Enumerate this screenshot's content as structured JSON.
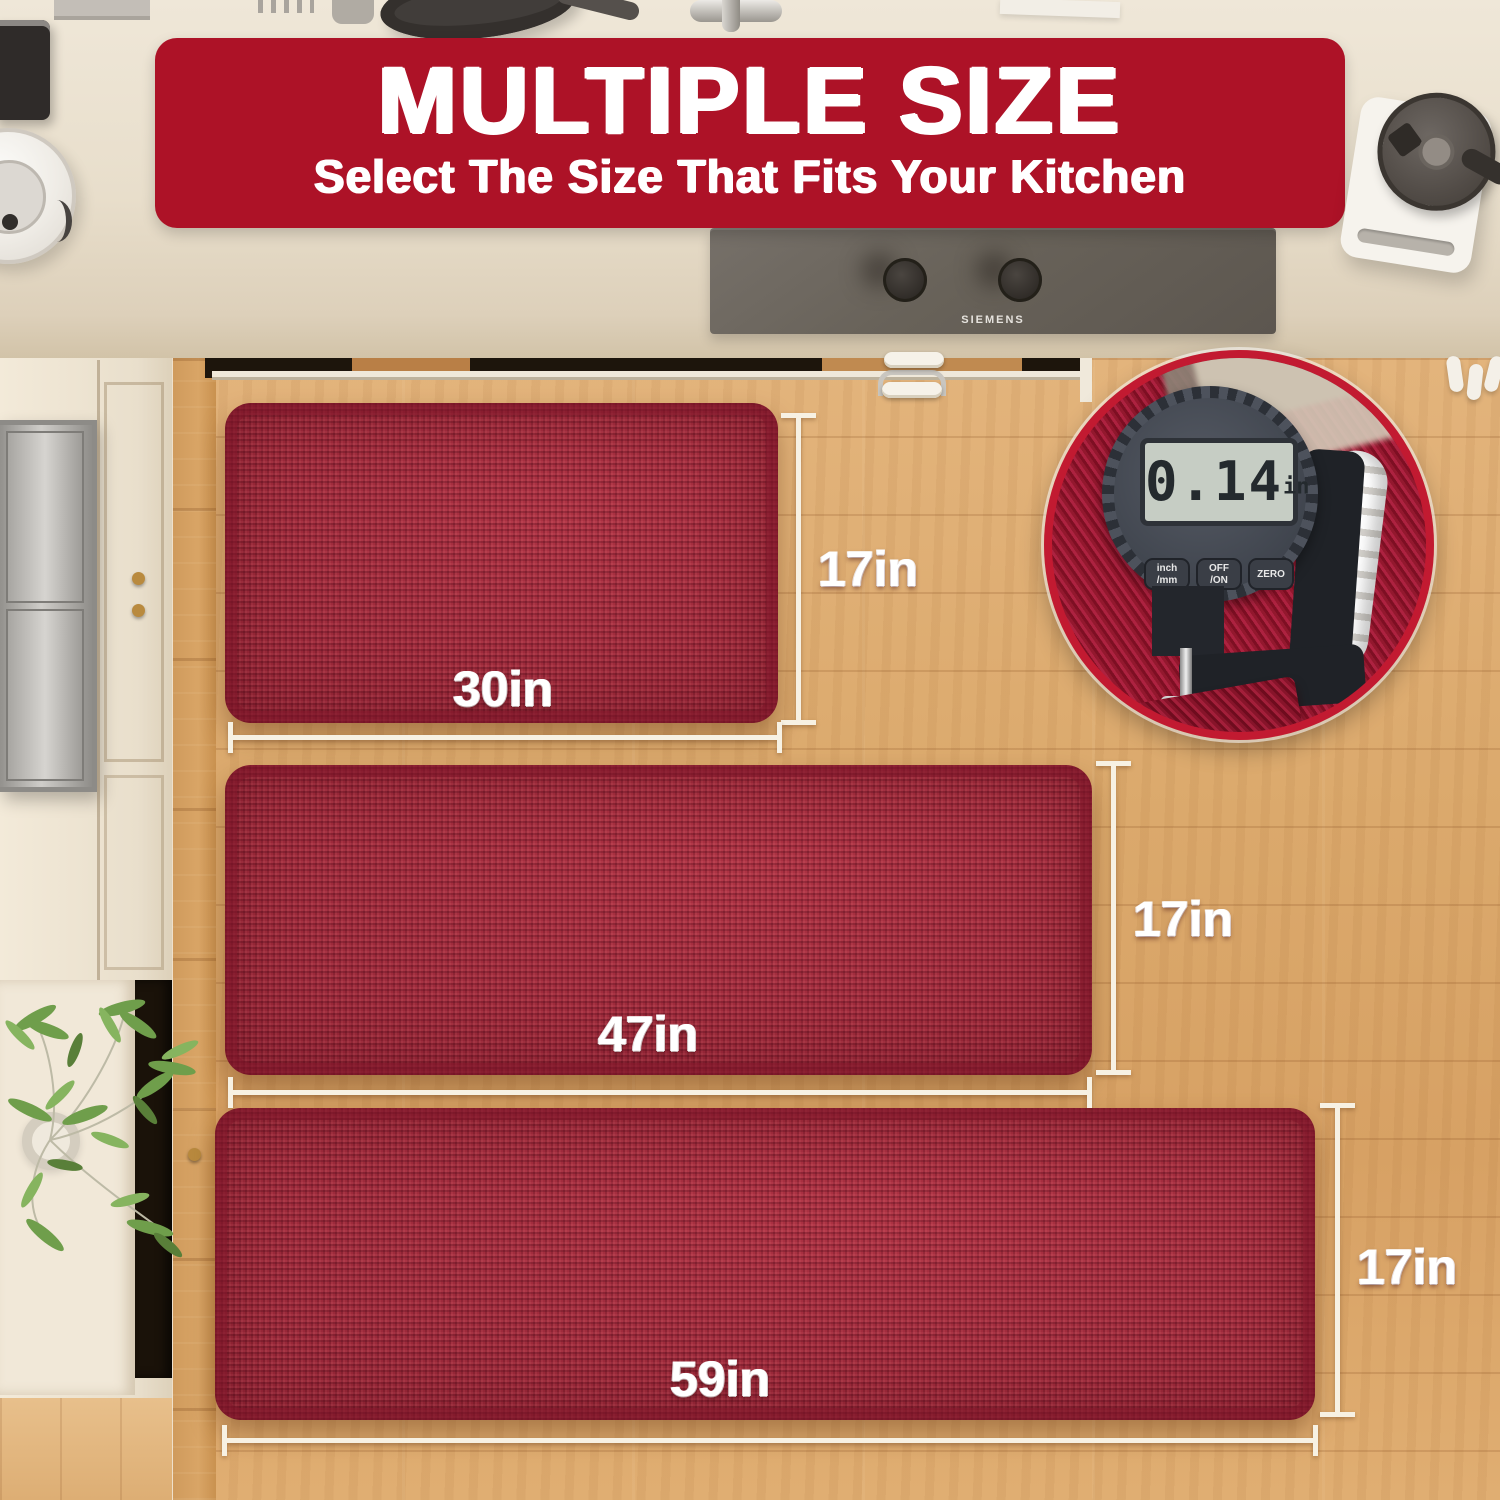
{
  "banner": {
    "title": "MULTIPLE SIZE",
    "subtitle": "Select The Size That Fits Your Kitchen"
  },
  "cooktop": {
    "brand": "SIEMENS"
  },
  "gauge": {
    "value": "0.14",
    "unit": "in",
    "buttons": [
      {
        "l1": "inch",
        "l2": "/mm"
      },
      {
        "l1": "OFF",
        "l2": "/ON"
      },
      {
        "l1": "ZERO",
        "l2": ""
      }
    ]
  },
  "mats": [
    {
      "width_label": "30in",
      "height_label": "17in"
    },
    {
      "width_label": "47in",
      "height_label": "17in"
    },
    {
      "width_label": "59in",
      "height_label": "17in"
    }
  ],
  "colors": {
    "banner_red": "#ad1227",
    "mat_red": "#a32a3d",
    "ring_red": "#c21a31",
    "floor_wood": "#dba96c",
    "counter_beige": "#e9dfcd"
  }
}
